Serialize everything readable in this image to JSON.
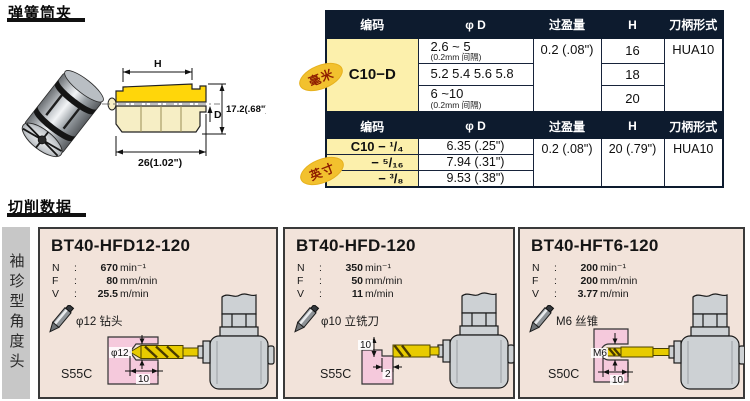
{
  "page": {
    "collets_title": "弹簧筒夹",
    "cutting_title": "切削数据",
    "sidebar_label": "袖珍型角度头"
  },
  "drawing": {
    "dim_h_label": "H",
    "dim_d_label": "D",
    "dim_total_height": "17.2(.68\")",
    "dim_total_width": "26(1.02\")"
  },
  "metric_table": {
    "tag_label": "毫米",
    "headers": {
      "code": "编码",
      "dia": "φ D",
      "interference": "过盈量",
      "h": "H",
      "shank": "刀柄形式"
    },
    "code": "C10−D",
    "rows": [
      {
        "dia_main": "2.6 ~ 5",
        "dia_sub": "(0.2mm 间隔)",
        "h": "16"
      },
      {
        "dia_main": "5.2 5.4 5.6 5.8",
        "dia_sub": "",
        "h": "18"
      },
      {
        "dia_main": "6 ~10",
        "dia_sub": "(0.2mm 间隔)",
        "h": "20"
      }
    ],
    "interference": "0.2 (.08\")",
    "shank": "HUA10"
  },
  "inch_table": {
    "tag_label": "英寸",
    "headers": {
      "code": "编码",
      "dia": "φ D",
      "interference": "过盈量",
      "h": "H",
      "shank": "刀柄形式"
    },
    "rows": [
      {
        "code": "C10 − ¹/₄",
        "dia": "6.35 (.25\")"
      },
      {
        "code": "− ⁵/₁₆",
        "dia": "7.94 (.31\")"
      },
      {
        "code": "− ³/₈",
        "dia": "9.53 (.38\")"
      }
    ],
    "interference": "0.2 (.08\")",
    "h": "20 (.79\")",
    "shank": "HUA10"
  },
  "spec_labels": {
    "n": "N",
    "f": "F",
    "v": "V",
    "colon": ":"
  },
  "panels": [
    {
      "title": "BT40-HFD12-120",
      "n_value": "670",
      "n_unit": "min⁻¹",
      "f_value": "80",
      "f_unit": "mm/min",
      "v_value": "25.5",
      "v_unit": "m/min",
      "tool_label": "φ12 钻头",
      "material": "S55C",
      "dim_a": "φ12",
      "dim_b": "10"
    },
    {
      "title": "BT40-HFD-120",
      "n_value": "350",
      "n_unit": "min⁻¹",
      "f_value": "50",
      "f_unit": "mm/min",
      "v_value": "11",
      "v_unit": "m/min",
      "tool_label": "φ10 立铣刀",
      "material": "S55C",
      "dim_a": "10",
      "dim_b": "2"
    },
    {
      "title": "BT40-HFT6-120",
      "n_value": "200",
      "n_unit": "min⁻¹",
      "f_value": "200",
      "f_unit": "mm/min",
      "v_value": "3.77",
      "v_unit": "m/min",
      "tool_label": "M6 丝锥",
      "material": "S50C",
      "dim_a": "M6",
      "dim_b": "10"
    }
  ],
  "colors": {
    "header_navy": "#0d1b2e",
    "cell_yellow": "#fcf0ac",
    "tag_yellow": "#f2c12e",
    "tag_text": "#8e1d00",
    "panel_bg": "#f2e3da",
    "workpiece_pink": "#f5c9dc",
    "tool_yellow": "#e8cb00",
    "head_gray": "#cdd1d4",
    "sidebar_gray": "#c7c7c7"
  }
}
